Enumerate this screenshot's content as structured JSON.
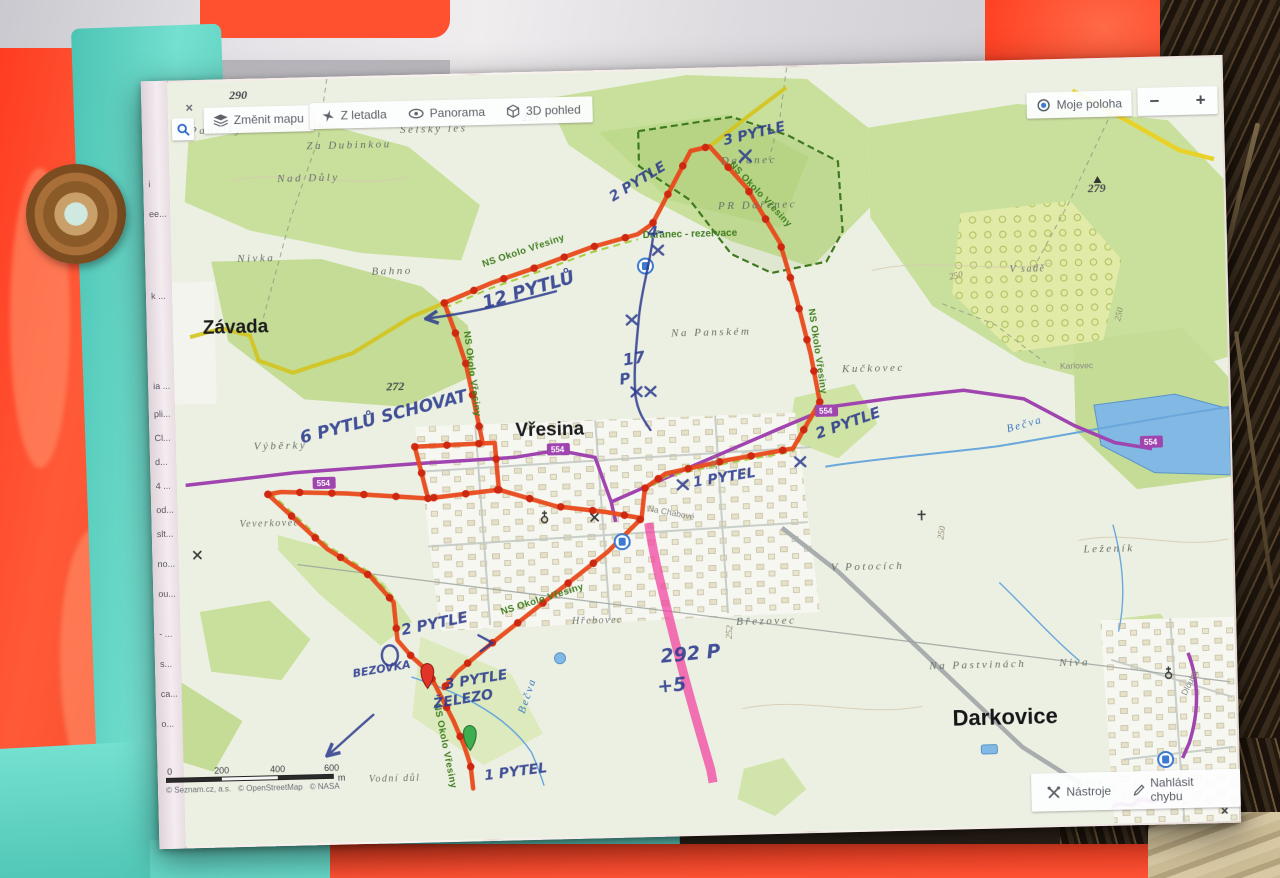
{
  "ui": {
    "close_icon": "×",
    "toolbar": {
      "change_map": "Změnit mapu",
      "from_plane": "Z letadla",
      "panorama": "Panorama",
      "view_3d": "3D pohled"
    },
    "location": {
      "my_location": "Moje poloha",
      "zoom_out": "−",
      "zoom_in": "+"
    },
    "footer": {
      "tools": "Nástroje",
      "report_bug": "Nahlásit chybu"
    },
    "scale": {
      "t0": "0",
      "t1": "200",
      "t2": "400",
      "t3": "600",
      "unit": "m"
    },
    "attribution": {
      "seznam": "© Seznam.cz, a.s.",
      "osm": "© OpenStreetMap",
      "nasa": "© NASA"
    },
    "sidebar_fragments": [
      "i",
      "ee...",
      "k ...",
      "ia ...",
      "pli...",
      "Cl...",
      "d...",
      "4 ...",
      "od...",
      "slt...",
      "no...",
      "ou...",
      "- ...",
      "s...",
      "ca...",
      "o...",
      "ic..."
    ]
  },
  "map": {
    "towns": {
      "zavada": "Závada",
      "vresina": "Vřesina",
      "darkovice": "Darkovice"
    },
    "areas": {
      "padelky": "Padělky",
      "za_dubinkou": "Za Dubinkou",
      "nad_duly": "Nad Důly",
      "selsky_les": "Selský les",
      "nivka": "Nivka",
      "bahno": "Bahno",
      "darenec": "Dařanec",
      "pr_darenec": "PR Dařenec",
      "darenec_rezervace": "Dařanec - rezervace",
      "na_panskem": "Na Panském",
      "kuckovec": "Kučkovec",
      "karlovec": "Karlovec",
      "v_sade": "V sadě",
      "lezenik": "Leženík",
      "v_potocich": "V Potocích",
      "na_pastvinach": "Na Pastvinách",
      "niva": "Niva",
      "brezovec": "Březovec",
      "hrebovec": "Hřebovec",
      "vyberky": "Výběrky",
      "veverkovec": "Veverkovec",
      "vodni_dul": "Vodní důl",
      "lany": "Lány",
      "na_chabove": "Na Chabové",
      "dlouha": "Dlouhá"
    },
    "water": {
      "becva": "Bečva"
    },
    "trail_name": "NS Okolo Vřesiny",
    "road_number": "554",
    "elevations": {
      "e290": "290",
      "e271": "271",
      "e279": "279",
      "e272": "272",
      "e250": "250",
      "e252": "252"
    }
  },
  "annotations": {
    "bags3_top": "3 PYTLE",
    "bags2_nw": "2 PYTLE",
    "minus4": "4-",
    "bags12": "12 PYTLŮ",
    "n17": "17",
    "p": "P",
    "bags6": "6 PYTLŮ SCHOVAT",
    "bags2_sw": "2 PYTLE",
    "bezovka": "BEZOVKA",
    "bags3_iron": "3 PYTLE",
    "zelezo": "ŽELEZO",
    "bag1_south": "1 PYTEL",
    "bag1_center": "1 PYTEL",
    "bags2_e": "2 PYTLE",
    "p292": "292 P",
    "plus5": "+5"
  },
  "colors": {
    "route_orange": "#e8491a",
    "waypoint_red": "#cf2810",
    "pen_blue": "#2b3a8e",
    "highlight_pink": "#f23f9f",
    "road_purple": "#a044b0",
    "trail_yellow": "#d4c41e",
    "trail_green": "#4a8a1f",
    "water_blue": "#74aede",
    "vest_orange": "#ff4a2e",
    "sheet_teal": "#69d8c9"
  }
}
